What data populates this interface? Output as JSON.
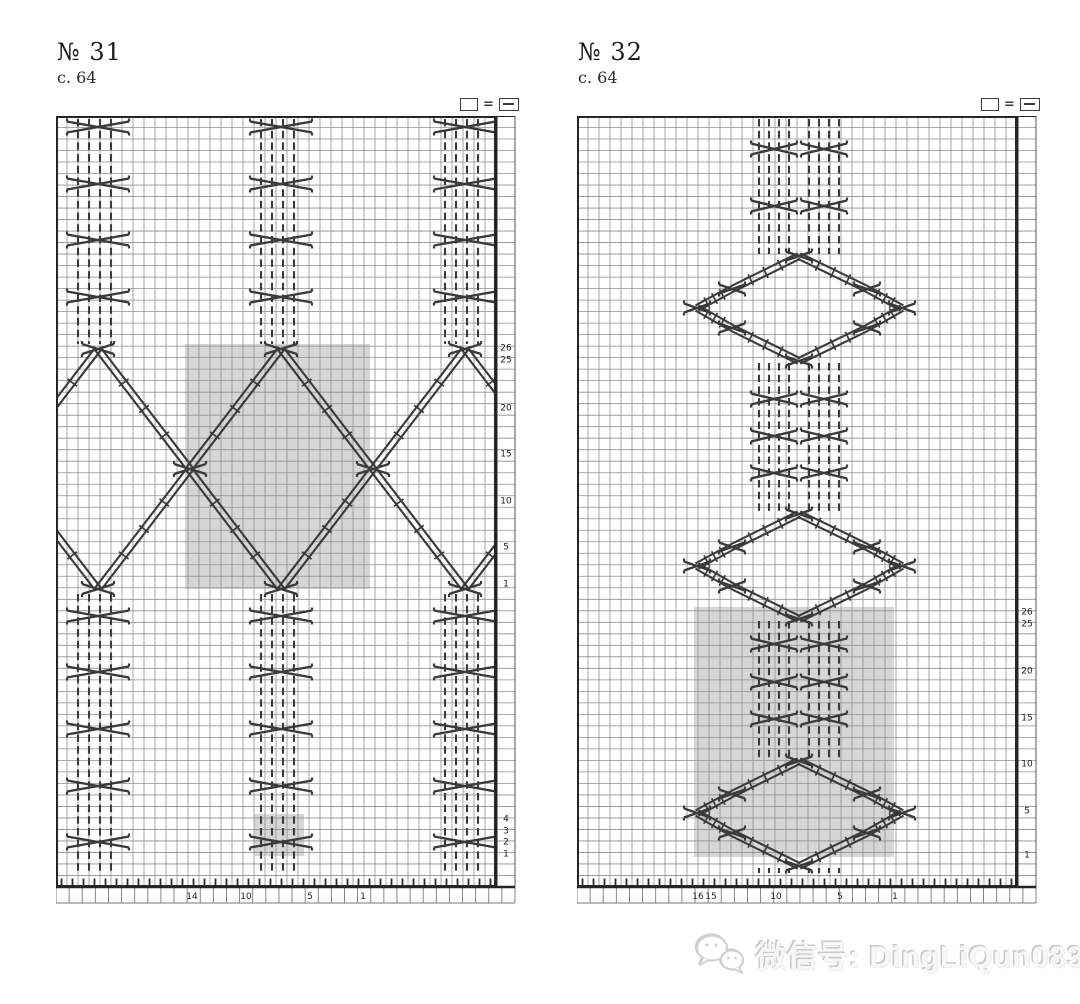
{
  "charts": [
    {
      "title": "№ 31",
      "page_ref": "c. 64",
      "legend": {
        "left_symbol": "knit-empty-square",
        "equals": "=",
        "right_symbol": "purl-dash-square"
      },
      "row_numbers_upper": [
        "26",
        "25",
        "20",
        "15",
        "10",
        "5",
        "1"
      ],
      "row_numbers_lower": [
        "4",
        "3",
        "2",
        "1"
      ],
      "stitch_numbers": [
        "14",
        "10",
        "5",
        "1"
      ]
    },
    {
      "title": "№ 32",
      "page_ref": "c. 64",
      "legend": {
        "left_symbol": "knit-empty-square",
        "equals": "=",
        "right_symbol": "purl-dash-square"
      },
      "row_numbers": [
        "26",
        "25",
        "20",
        "15",
        "10",
        "5",
        "1"
      ],
      "stitch_numbers": [
        "16",
        "15",
        "10",
        "5",
        "1"
      ]
    }
  ],
  "watermark": {
    "icon": "wechat-icon",
    "text": "微信号: DingLiQun0830"
  },
  "colors": {
    "shaded": "#d6d6d6",
    "grid_line": "#8f8f8f",
    "border": "#262626",
    "symbol": "#3a3a3a",
    "number_text": "#222222"
  }
}
